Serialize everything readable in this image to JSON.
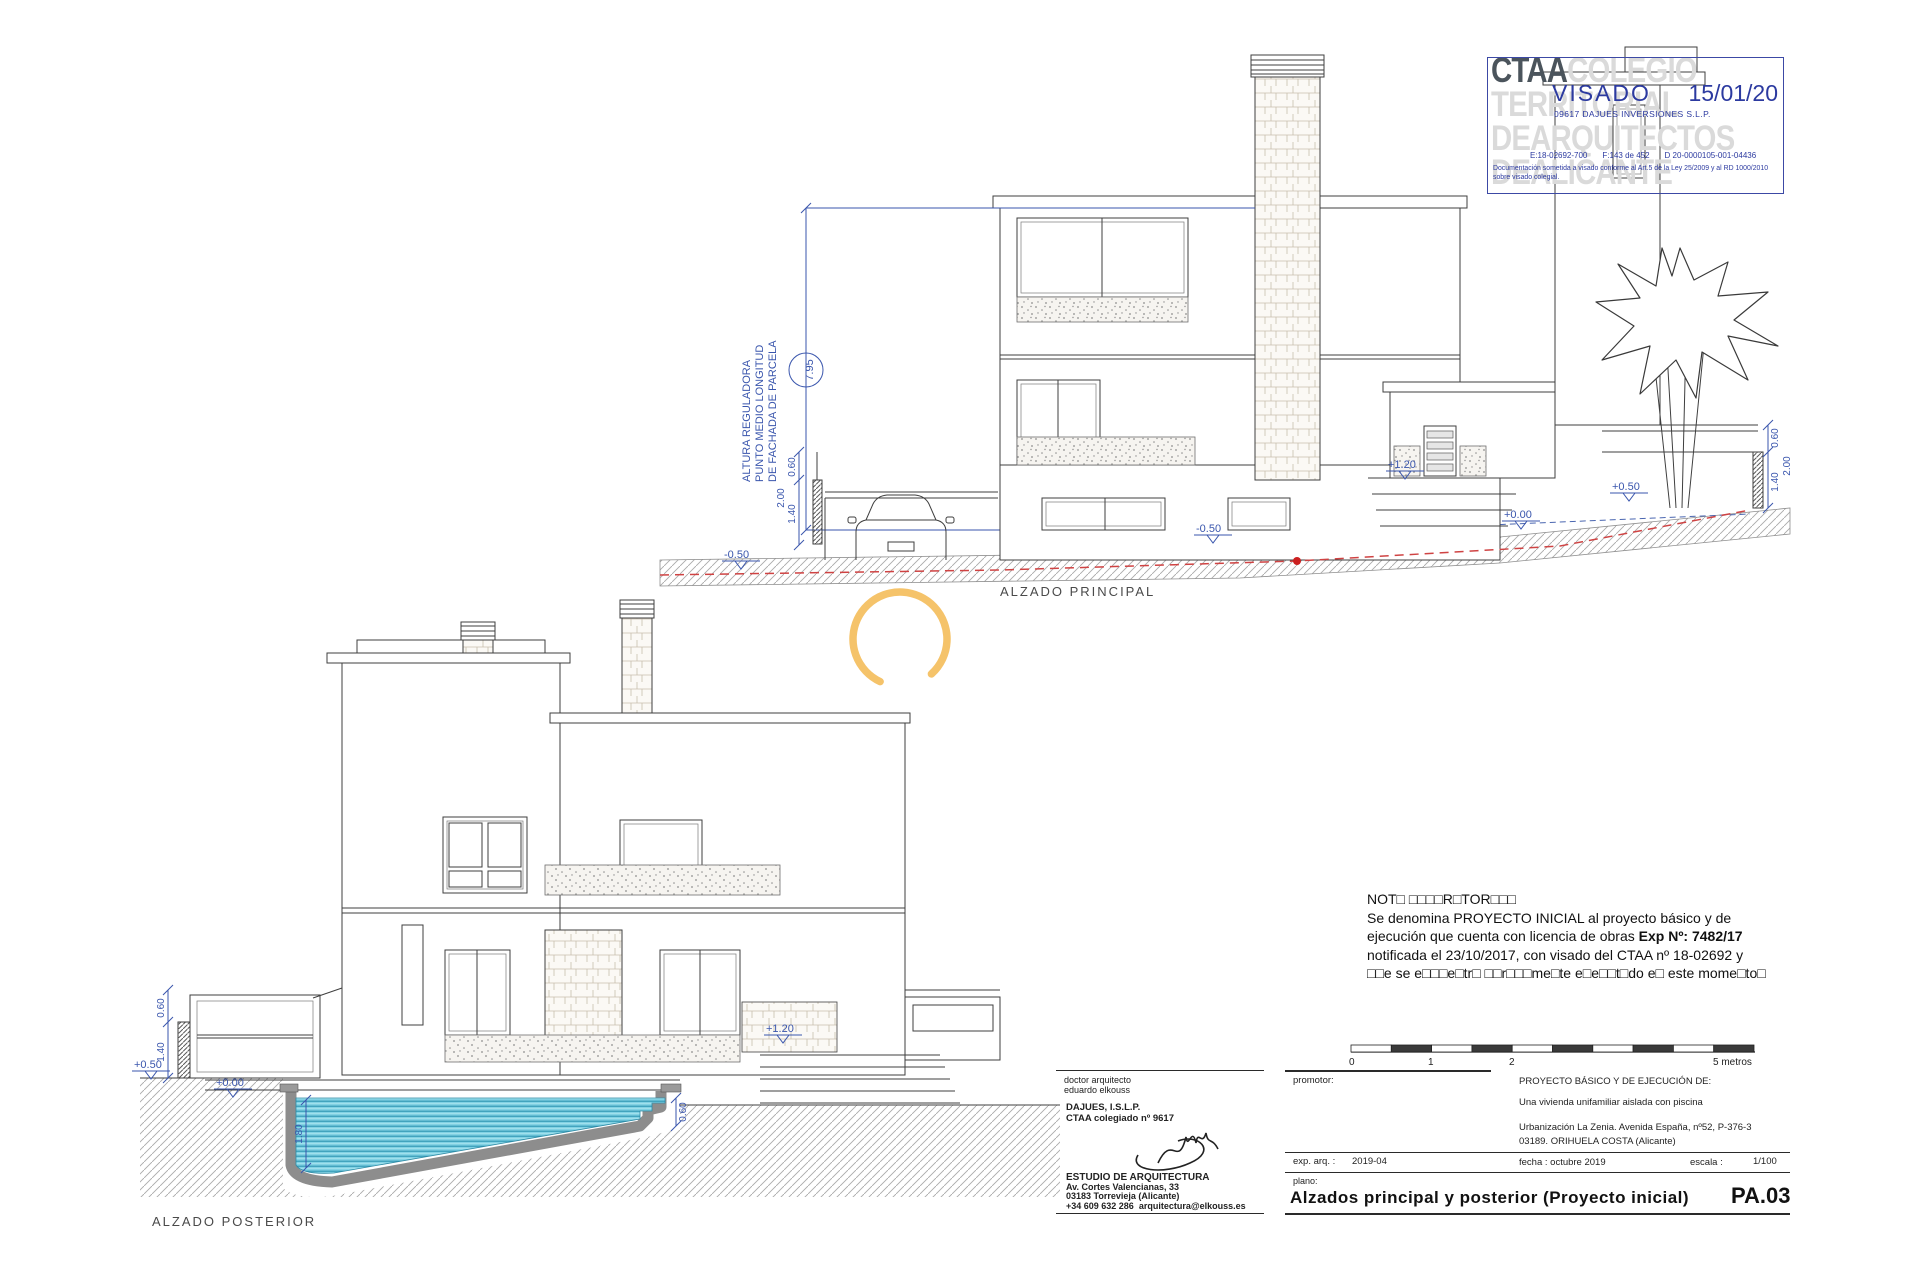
{
  "colors": {
    "annotation_blue": "#3a56ad",
    "terrain_red": "#cf4343",
    "stamp_blue": "#2c3aa0",
    "watermark_gray": "#dadada",
    "pool_water": "#82d2e4",
    "arc_orange": "#f5c36a"
  },
  "stamp": {
    "org": "CTAA",
    "wm1": "COLEGIO",
    "wm2": "TERRITORIAL",
    "wm3": "DEARQUITECTOS",
    "wm4": "DEALICANTE",
    "visado": "VISADO",
    "date": "15/01/20",
    "client": "09617 DAJUES INVERSIONES S.L.P.",
    "ref_e": "E:18-02692-700",
    "ref_f": "F:143 de 452",
    "ref_d": "D 20-0000105-001-04436",
    "legal": "Documentación sometida a visado conforme al Art.5 de la Ley 25/2009 y al RD 1000/2010 sobre visado colegial."
  },
  "principal": {
    "label": "ALZADO  PRINCIPAL",
    "caption1": "ALTURA REGULADORA",
    "caption2": "PUNTO MEDIO LONGITUD",
    "caption3": "DE FACHADA DE PARCELA",
    "height": "7.95"
  },
  "posterior": {
    "label": "ALZADO  POSTERIOR"
  },
  "dims": {
    "d060": "0.60",
    "d140": "1.40",
    "d200": "2.00",
    "d180": "1.80",
    "lm050": "-0.50",
    "lp050": "+0.50",
    "lp120": "+1.20",
    "lp000": "+0.00"
  },
  "nota": {
    "l1": "NOT□ □□□□R□TOR□□□",
    "l2": "Se denomina PROYECTO INICIAL al proyecto básico y de",
    "l3a": "ejecución que cuenta con licencia de obras ",
    "l3b": "Exp Nº: 7482/17",
    "l4": "notificada el 23/10/2017, con visado del CTAA nº 18-02692 y",
    "l5": "□□e se e□□□e□tr□ □□r□□□me□te e□e□□t□do e□ este mome□to□"
  },
  "titleblock": {
    "architect": {
      "l1": "doctor arquitecto",
      "l2": "eduardo elkouss",
      "firm": "DAJUES, I.S.L.P.",
      "college": "CTAA colegiado nº 9617",
      "studio": "ESTUDIO DE ARQUITECTURA",
      "address1": "Av. Cortes Valencianas, 33",
      "address2": "03183 Torrevieja (Alicante)",
      "phone": "+34 609 632 286",
      "email": "arquitectura@elkouss.es"
    },
    "promotor_label": "promotor:",
    "exp_label": "exp. arq. :",
    "exp_value": "2019-04",
    "plano_label": "plano:",
    "project_heading": "PROYECTO BÁSICO Y DE EJECUCIÓN DE:",
    "project_desc": "Una vivienda unifamiliar aislada con piscina",
    "address_line1": "Urbanización La Zenia. Avenida España, nº52, P-376-3",
    "address_line2": "03189. ORIHUELA COSTA (Alicante)",
    "fecha": "fecha : octubre 2019",
    "escala_label": "escala :",
    "escala_value": "1/100",
    "sheet_title": "Alzados principal y posterior (Proyecto inicial)",
    "sheet_code": "PA.03",
    "scalebar": {
      "t0": "0",
      "t1": "1",
      "t2": "2",
      "t5": "5 metros"
    }
  }
}
